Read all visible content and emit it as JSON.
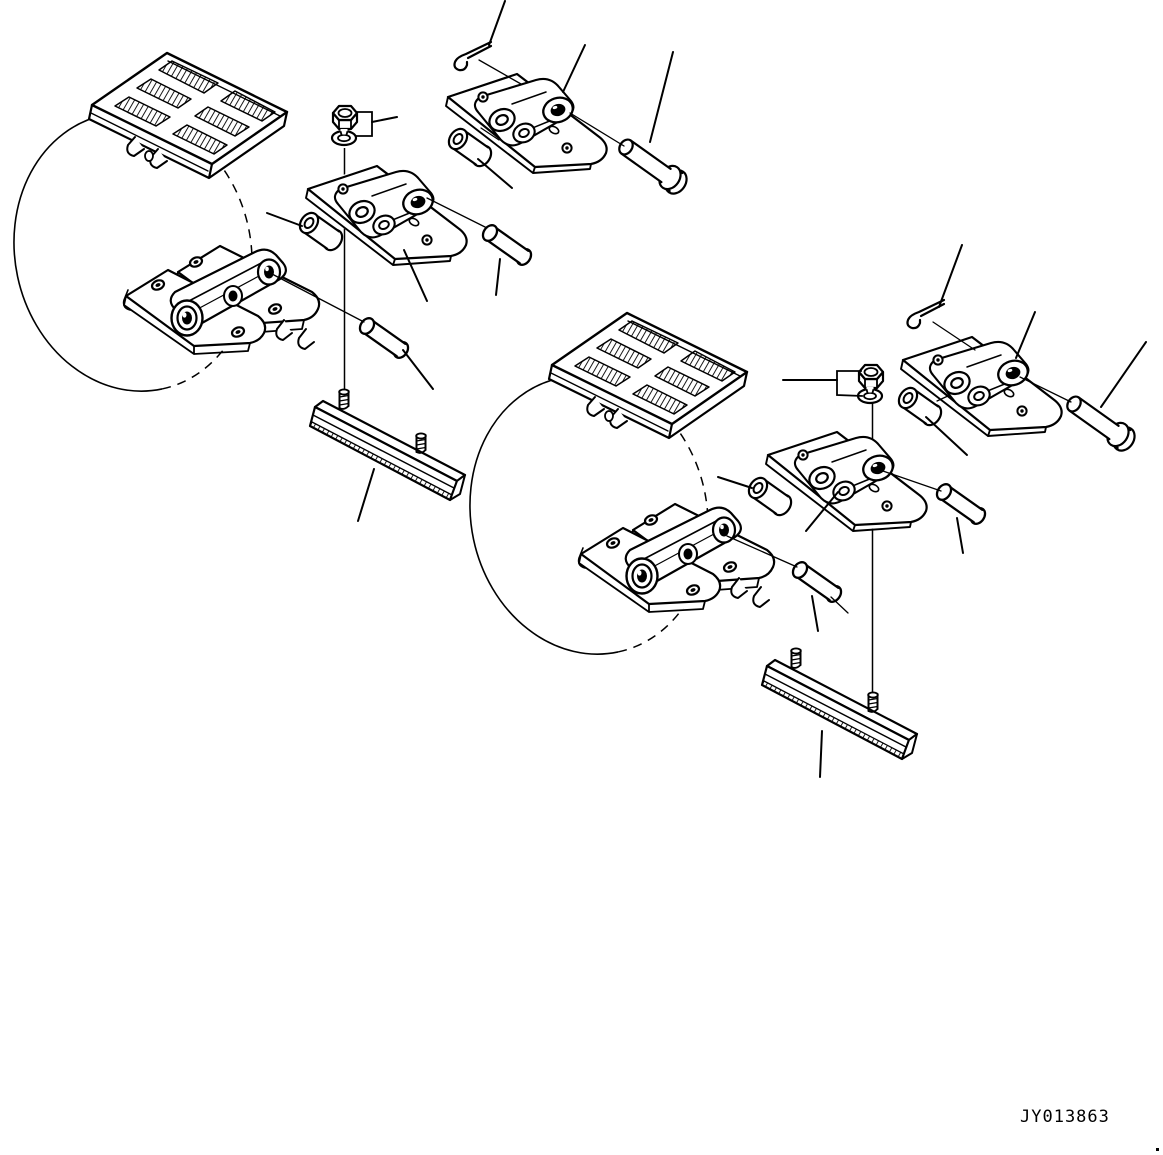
{
  "figure": {
    "code": "JY013863",
    "kind": "exploded-parts-diagram",
    "subject": "rubber-pad track shoe assembly",
    "background_color": "#ffffff",
    "line_color": "#000000"
  },
  "assemblies": {
    "left": {
      "name": "left-track-shoe-assembly",
      "parts": [
        "rubber-pad-track-shoe",
        "track-loop-ellipse",
        "hex-nut",
        "lock-washer",
        "track-link-with-shoe-plate",
        "double-track-link-assembly",
        "bushing",
        "pin-upper",
        "pin-lower",
        "track-shoe-plate-with-studs"
      ]
    },
    "top_center": {
      "name": "master-link-set-top-center",
      "parts": [
        "cotter-pin",
        "master-link-with-shoe-plate",
        "bushing",
        "master-pin"
      ]
    },
    "right": {
      "name": "right-track-shoe-assembly",
      "parts": [
        "rubber-pad-track-shoe",
        "track-loop-ellipse",
        "hex-nut",
        "lock-washer",
        "track-link-with-shoe-plate",
        "double-track-link-assembly",
        "bushing",
        "pin-upper",
        "pin-lower",
        "track-shoe-plate-with-studs"
      ]
    },
    "top_right": {
      "name": "master-link-set-top-right",
      "parts": [
        "cotter-pin",
        "master-link-with-shoe-plate",
        "bushing",
        "master-pin"
      ]
    }
  }
}
